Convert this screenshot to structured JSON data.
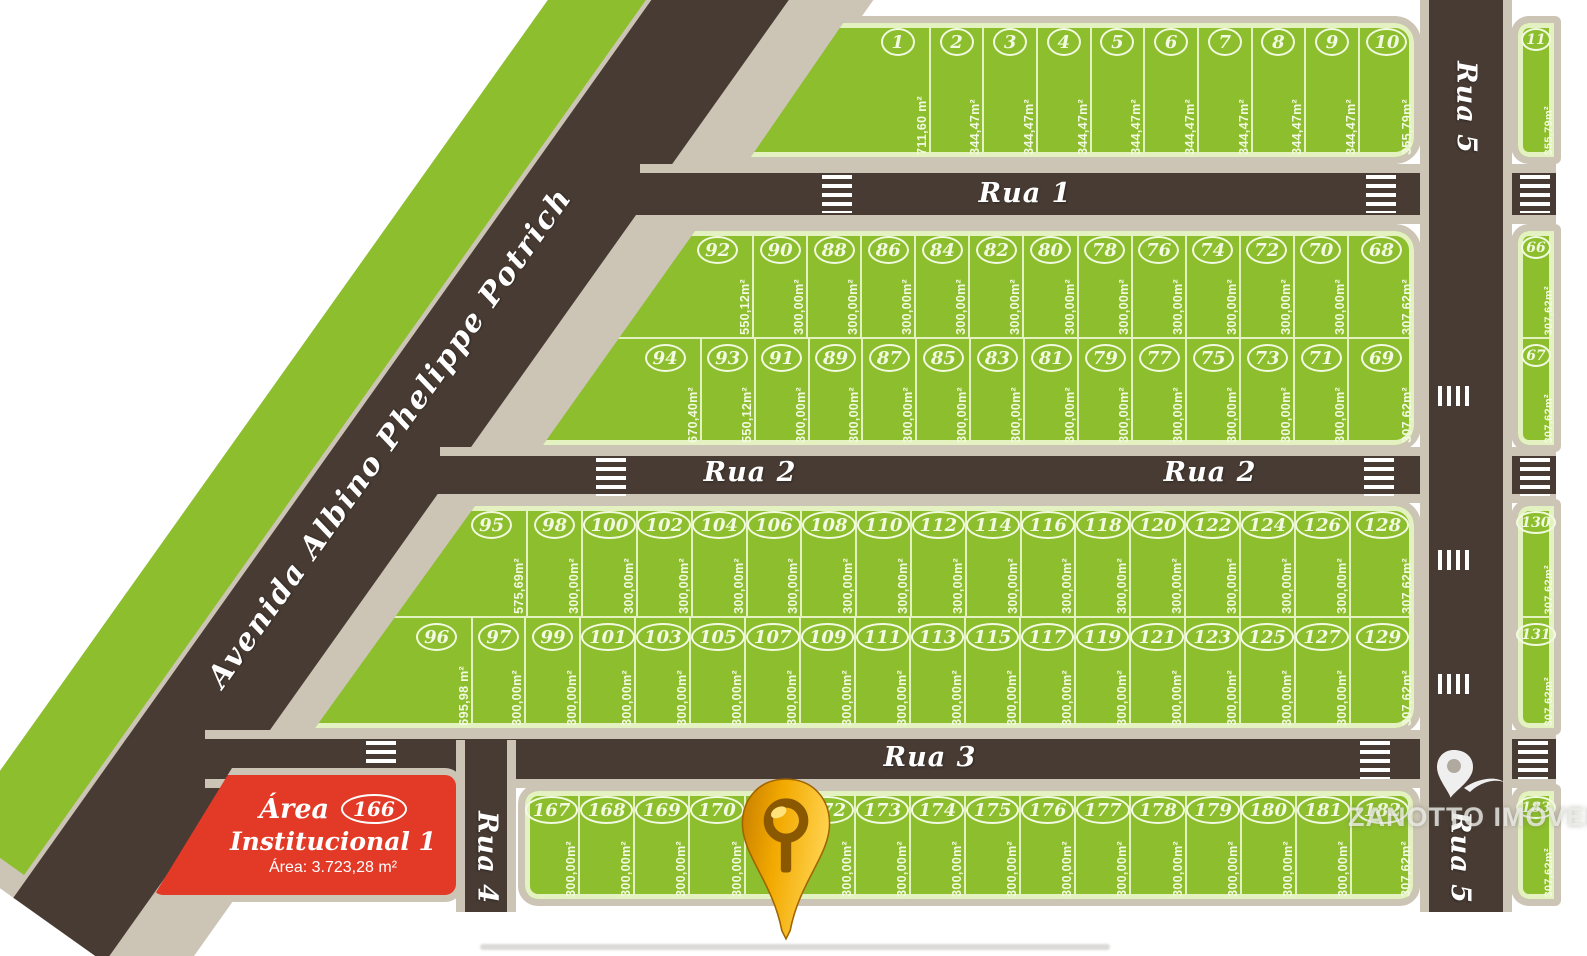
{
  "watermark": {
    "brand": "ZANOTTO IMÓVEIS"
  },
  "avenue_label": "Avenida Albino Phelippe Potrich",
  "street_labels": {
    "rua1": "Rua 1",
    "rua2_left": "Rua 2",
    "rua2_right": "Rua 2",
    "rua3": "Rua 3",
    "rua4": "Rua 4",
    "rua5_top": "Rua 5",
    "rua5_bottom": "Rua 5"
  },
  "institutional_area": {
    "line1": "Área",
    "badge": "166",
    "line2": "Institucional 1",
    "area_label": "Área: 3.723,28 m²"
  },
  "blocks": {
    "block1": [
      {
        "n": "1",
        "area": "711,60 m²",
        "w": 4.1
      },
      {
        "n": "2",
        "area": "344,47m²"
      },
      {
        "n": "3",
        "area": "344,47m²"
      },
      {
        "n": "4",
        "area": "344,47m²"
      },
      {
        "n": "5",
        "area": "344,47m²"
      },
      {
        "n": "6",
        "area": "344,47m²"
      },
      {
        "n": "7",
        "area": "344,47m²"
      },
      {
        "n": "8",
        "area": "344,47m²"
      },
      {
        "n": "9",
        "area": "344,47m²"
      },
      {
        "n": "10",
        "area": "355,79m²",
        "w": 1.05
      }
    ],
    "block2_top": [
      {
        "n": "92",
        "area": "550,12m²",
        "w": 4.9
      },
      {
        "n": "90",
        "area": "300,00m²"
      },
      {
        "n": "88",
        "area": "300,00m²"
      },
      {
        "n": "86",
        "area": "300,00m²"
      },
      {
        "n": "84",
        "area": "300,00m²"
      },
      {
        "n": "82",
        "area": "300,00m²"
      },
      {
        "n": "80",
        "area": "300,00m²"
      },
      {
        "n": "78",
        "area": "300,00m²"
      },
      {
        "n": "76",
        "area": "300,00m²"
      },
      {
        "n": "74",
        "area": "300,00m²"
      },
      {
        "n": "72",
        "area": "300,00m²"
      },
      {
        "n": "70",
        "area": "300,00m²"
      },
      {
        "n": "68",
        "area": "307,62m²",
        "w": 1.25
      }
    ],
    "block2_bottom": [
      {
        "n": "94",
        "area": "670,40m²",
        "w": 3.9
      },
      {
        "n": "93",
        "area": "550,12m²"
      },
      {
        "n": "91",
        "area": "300,00m²"
      },
      {
        "n": "89",
        "area": "300,00m²"
      },
      {
        "n": "87",
        "area": "300,00m²"
      },
      {
        "n": "85",
        "area": "300,00m²"
      },
      {
        "n": "83",
        "area": "300,00m²"
      },
      {
        "n": "81",
        "area": "300,00m²"
      },
      {
        "n": "79",
        "area": "300,00m²"
      },
      {
        "n": "77",
        "area": "300,00m²"
      },
      {
        "n": "75",
        "area": "300,00m²"
      },
      {
        "n": "73",
        "area": "300,00m²"
      },
      {
        "n": "71",
        "area": "300,00m²"
      },
      {
        "n": "69",
        "area": "307,62m²",
        "w": 1.25
      }
    ],
    "block3_top": [
      {
        "n": "95",
        "area": "575,69m²",
        "w": 4.85
      },
      {
        "n": "98",
        "area": "300,00m²"
      },
      {
        "n": "100",
        "area": "300,00m²"
      },
      {
        "n": "102",
        "area": "300,00m²"
      },
      {
        "n": "104",
        "area": "300,00m²"
      },
      {
        "n": "106",
        "area": "300,00m²"
      },
      {
        "n": "108",
        "area": "300,00m²"
      },
      {
        "n": "110",
        "area": "300,00m²"
      },
      {
        "n": "112",
        "area": "300,00m²"
      },
      {
        "n": "114",
        "area": "300,00m²"
      },
      {
        "n": "116",
        "area": "300,00m²"
      },
      {
        "n": "118",
        "area": "300,00m²"
      },
      {
        "n": "120",
        "area": "300,00m²"
      },
      {
        "n": "122",
        "area": "300,00m²"
      },
      {
        "n": "124",
        "area": "300,00m²"
      },
      {
        "n": "126",
        "area": "300,00m²"
      },
      {
        "n": "128",
        "area": "307,62m²",
        "w": 1.2
      }
    ],
    "block3_bottom": [
      {
        "n": "96",
        "area": "695,98 m²",
        "w": 3.8
      },
      {
        "n": "97",
        "area": "300,00m²",
        "w": 0.97
      },
      {
        "n": "99",
        "area": "300,00m²"
      },
      {
        "n": "101",
        "area": "300,00m²"
      },
      {
        "n": "103",
        "area": "300,00m²"
      },
      {
        "n": "105",
        "area": "300,00m²"
      },
      {
        "n": "107",
        "area": "300,00m²"
      },
      {
        "n": "109",
        "area": "300,00m²"
      },
      {
        "n": "111",
        "area": "300,00m²"
      },
      {
        "n": "113",
        "area": "300,00m²"
      },
      {
        "n": "115",
        "area": "300,00m²"
      },
      {
        "n": "117",
        "area": "300,00m²"
      },
      {
        "n": "119",
        "area": "300,00m²"
      },
      {
        "n": "121",
        "area": "300,00m²"
      },
      {
        "n": "123",
        "area": "300,00m²"
      },
      {
        "n": "125",
        "area": "300,00m²"
      },
      {
        "n": "127",
        "area": "300,00m²"
      },
      {
        "n": "129",
        "area": "307,62m²",
        "w": 1.2
      }
    ],
    "block4": [
      {
        "n": "167",
        "area": "300,00m²"
      },
      {
        "n": "168",
        "area": "300,00m²"
      },
      {
        "n": "169",
        "area": "300,00m²"
      },
      {
        "n": "170",
        "area": "300,00m²"
      },
      {
        "n": "171",
        "area": "300,00m²"
      },
      {
        "n": "172",
        "area": "300,00m²"
      },
      {
        "n": "173",
        "area": "300,00m²"
      },
      {
        "n": "174",
        "area": "300,00m²"
      },
      {
        "n": "175",
        "area": "300,00m²"
      },
      {
        "n": "176",
        "area": "300,00m²"
      },
      {
        "n": "177",
        "area": "300,00m²"
      },
      {
        "n": "178",
        "area": "300,00m²"
      },
      {
        "n": "179",
        "area": "300,00m²"
      },
      {
        "n": "180",
        "area": "300,00m²"
      },
      {
        "n": "181",
        "area": "300,00m²"
      },
      {
        "n": "182",
        "area": "307,62m²",
        "w": 1.15
      }
    ],
    "col1": [
      {
        "n": "11",
        "area": "355,79m²"
      }
    ],
    "col2": [
      {
        "n": "66",
        "area": "307,62m²"
      },
      {
        "n": "67",
        "area": "307,62m²"
      }
    ],
    "col3": [
      {
        "n": "130",
        "area": "307,62m²"
      },
      {
        "n": "131",
        "area": "307,62m²"
      }
    ],
    "col4": [
      {
        "n": "183",
        "area": "307,62m²"
      }
    ]
  },
  "colors": {
    "lot_green": "#8dbe2d",
    "lot_line": "#e3f2c0",
    "road_dark": "#473b33",
    "sidewalk_beige": "#ccc5b5",
    "institutional_red": "#e23a27",
    "lot_text": "#f2fae1",
    "pin_gold": "#f2a900"
  }
}
